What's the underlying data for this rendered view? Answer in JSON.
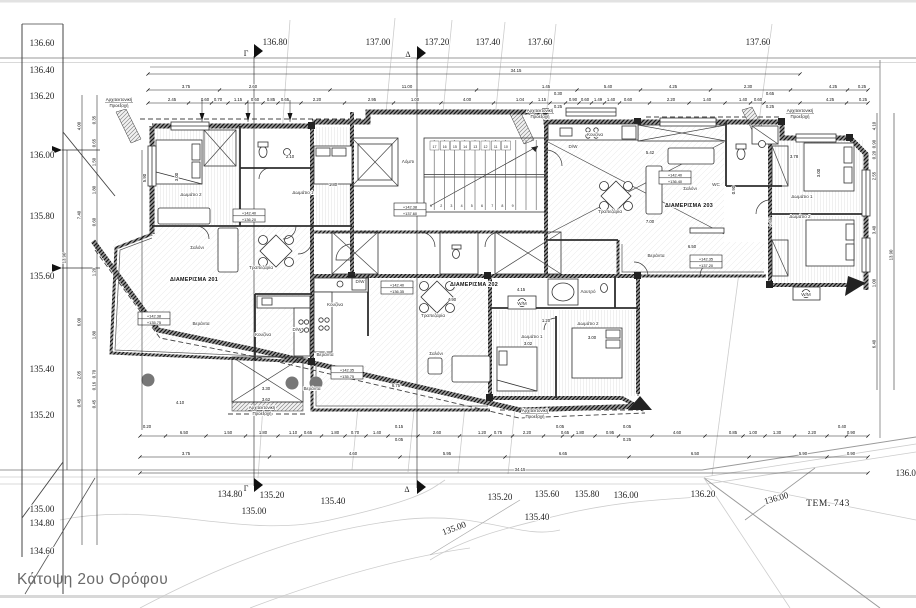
{
  "drawing": {
    "title": "Κάτοψη 2ου Ορόφου",
    "plot_label": "ΤΕΜ. 743"
  },
  "section_markers": {
    "gamma": "Γ",
    "delta": "Δ"
  },
  "colors": {
    "wall": "#3c3c3c",
    "contour": "#cccccc",
    "title_text": "#6a6a6a",
    "paper": "#ffffff"
  },
  "left_elevation_scale": [
    {
      "label": "136.60",
      "y": 43
    },
    {
      "label": "136.40",
      "y": 70
    },
    {
      "label": "136.20",
      "y": 96
    },
    {
      "label": "136.00",
      "y": 155
    },
    {
      "label": "135.80",
      "y": 216
    },
    {
      "label": "135.60",
      "y": 276
    },
    {
      "label": "135.40",
      "y": 369
    },
    {
      "label": "135.20",
      "y": 415
    },
    {
      "label": "135.00",
      "y": 509
    },
    {
      "label": "134.80",
      "y": 523
    },
    {
      "label": "134.60",
      "y": 551
    }
  ],
  "contour_labels": [
    {
      "t": "136.80",
      "x": 275,
      "y": 42
    },
    {
      "t": "137.00",
      "x": 378,
      "y": 42
    },
    {
      "t": "137.20",
      "x": 437,
      "y": 42
    },
    {
      "t": "137.40",
      "x": 488,
      "y": 42
    },
    {
      "t": "137.60",
      "x": 540,
      "y": 42
    },
    {
      "t": "137.60",
      "x": 758,
      "y": 42
    },
    {
      "t": "134.80",
      "x": 230,
      "y": 494
    },
    {
      "t": "135.20",
      "x": 272,
      "y": 495
    },
    {
      "t": "135.00",
      "x": 254,
      "y": 511
    },
    {
      "t": "135.40",
      "x": 333,
      "y": 501
    },
    {
      "t": "135.00",
      "x": 455,
      "y": 528,
      "rot": -20
    },
    {
      "t": "135.20",
      "x": 500,
      "y": 497
    },
    {
      "t": "135.60",
      "x": 547,
      "y": 494
    },
    {
      "t": "135.40",
      "x": 537,
      "y": 517
    },
    {
      "t": "135.80",
      "x": 587,
      "y": 494
    },
    {
      "t": "136.00",
      "x": 626,
      "y": 495
    },
    {
      "t": "136.20",
      "x": 703,
      "y": 494
    },
    {
      "t": "136.00",
      "x": 777,
      "y": 498,
      "rot": -16
    },
    {
      "t": "136.00",
      "x": 908,
      "y": 473
    }
  ],
  "apartment_labels": [
    {
      "t": "ΔΙΑΜΕΡΙΣΜΑ 201",
      "x": 194,
      "y": 281
    },
    {
      "t": "ΔΙΑΜΕΡΙΣΜΑ 202",
      "x": 474,
      "y": 286
    },
    {
      "t": "ΔΙΑΜΕΡΙΣΜΑ 203",
      "x": 689,
      "y": 207
    }
  ],
  "room_labels": [
    {
      "t": "Δωμάτιο 2",
      "x": 191,
      "y": 196
    },
    {
      "t": "Δωμάτιο 1",
      "x": 303,
      "y": 194
    },
    {
      "t": "Σαλόνι",
      "x": 197,
      "y": 249
    },
    {
      "t": "Τραπεζαρία",
      "x": 261,
      "y": 269
    },
    {
      "t": "Κουζίνα",
      "x": 263,
      "y": 336
    },
    {
      "t": "D/W",
      "x": 297,
      "y": 331
    },
    {
      "t": "Βεράντα",
      "x": 201,
      "y": 325
    },
    {
      "t": "Βεράντα",
      "x": 325,
      "y": 356
    },
    {
      "t": "Λόμπι",
      "x": 408,
      "y": 163
    },
    {
      "t": "Κουζίνα",
      "x": 335,
      "y": 306
    },
    {
      "t": "D/W",
      "x": 360,
      "y": 283
    },
    {
      "t": "Τραπεζαρία",
      "x": 433,
      "y": 317
    },
    {
      "t": "Σαλόνι",
      "x": 436,
      "y": 355
    },
    {
      "t": "Βεράντα",
      "x": 312,
      "y": 390
    },
    {
      "t": "Λουτρό",
      "x": 588,
      "y": 293
    },
    {
      "t": "W/M",
      "x": 522,
      "y": 305
    },
    {
      "t": "Δωμάτιο 1",
      "x": 532,
      "y": 338
    },
    {
      "t": "Δωμάτιο 2",
      "x": 588,
      "y": 325
    },
    {
      "t": "Κουζίνα",
      "x": 595,
      "y": 136
    },
    {
      "t": "D/W",
      "x": 573,
      "y": 148
    },
    {
      "t": "Τραπεζαρία",
      "x": 610,
      "y": 213
    },
    {
      "t": "Σαλόνι",
      "x": 690,
      "y": 190
    },
    {
      "t": "WC",
      "x": 716,
      "y": 186
    },
    {
      "t": "Βεράντα",
      "x": 656,
      "y": 257
    },
    {
      "t": "Δωμάτιο 1",
      "x": 802,
      "y": 198
    },
    {
      "t": "Δωμάτιο 2",
      "x": 800,
      "y": 218
    },
    {
      "t": "W/M",
      "x": 806,
      "y": 296
    }
  ],
  "level_markers": [
    {
      "main": "+142.40",
      "sub": "+136.20",
      "x": 249,
      "y": 209
    },
    {
      "main": "+142.38",
      "sub": "+135.75",
      "x": 154,
      "y": 312
    },
    {
      "main": "+142.38",
      "sub": "+137.60",
      "x": 410,
      "y": 203
    },
    {
      "main": "+142.40",
      "sub": "+136.35",
      "x": 397,
      "y": 281
    },
    {
      "main": "+142.35",
      "sub": "+135.75",
      "x": 347,
      "y": 366
    },
    {
      "main": "+142.40",
      "sub": "+136.40",
      "x": 675,
      "y": 171
    },
    {
      "main": "+142.35",
      "sub": "+137.20",
      "x": 706,
      "y": 255
    }
  ],
  "projection_note": {
    "line1": "Αρχιτεκτονική",
    "line2": "Προεξοχή",
    "positions": [
      {
        "x": 119,
        "y": 101
      },
      {
        "x": 540,
        "y": 112
      },
      {
        "x": 800,
        "y": 112
      },
      {
        "x": 535,
        "y": 412
      },
      {
        "x": 262,
        "y": 409
      }
    ]
  },
  "stairs": {
    "top_numbers": [
      "17",
      "16",
      "15",
      "14",
      "13",
      "12",
      "11",
      "10"
    ],
    "bottom_numbers": [
      "1",
      "2",
      "3",
      "4",
      "5",
      "6",
      "7",
      "8",
      "9"
    ]
  },
  "dimensions": {
    "h_rows": [
      {
        "y": 74,
        "x1": 148,
        "x2": 800,
        "items": [
          {
            "v": "34.15",
            "x": 516
          }
        ]
      },
      {
        "y": 90,
        "x1": 148,
        "x2": 868,
        "items": [
          {
            "v": "3.75",
            "x": 186
          },
          {
            "v": "2.60",
            "x": 253
          },
          {
            "v": "11.00",
            "x": 407
          },
          {
            "v": "1.45",
            "x": 546
          },
          {
            "v": "5.40",
            "x": 608
          },
          {
            "v": "4.25",
            "x": 673
          },
          {
            "v": "2.30",
            "x": 748
          },
          {
            "v": "4.25",
            "x": 833
          },
          {
            "v": "0.25",
            "x": 862
          }
        ]
      },
      {
        "y": 103,
        "x1": 148,
        "x2": 868,
        "items": [
          {
            "v": "2.45",
            "x": 172
          },
          {
            "v": "0.60",
            "x": 205
          },
          {
            "v": "0.70",
            "x": 218
          },
          {
            "v": "1.15",
            "x": 238
          },
          {
            "v": "0.60",
            "x": 255
          },
          {
            "v": "0.85",
            "x": 271
          },
          {
            "v": "0.65",
            "x": 285
          },
          {
            "v": "2.20",
            "x": 317
          },
          {
            "v": "2.95",
            "x": 372
          },
          {
            "v": "1.00",
            "x": 415
          },
          {
            "v": "4.00",
            "x": 467
          },
          {
            "v": "1.04",
            "x": 520
          },
          {
            "v": "1.15",
            "x": 542
          },
          {
            "v": "0.30",
            "x": 558,
            "dy": -6
          },
          {
            "v": "0.25",
            "x": 558,
            "dy": 7
          },
          {
            "v": "0.90",
            "x": 573
          },
          {
            "v": "0.60",
            "x": 585
          },
          {
            "v": "1.49",
            "x": 598
          },
          {
            "v": "1.40",
            "x": 611
          },
          {
            "v": "0.60",
            "x": 628
          },
          {
            "v": "2.20",
            "x": 671
          },
          {
            "v": "1.40",
            "x": 707
          },
          {
            "v": "1.40",
            "x": 743
          },
          {
            "v": "0.60",
            "x": 758
          },
          {
            "v": "0.65",
            "x": 770,
            "dy": -6
          },
          {
            "v": "0.25",
            "x": 770,
            "dy": 7
          },
          {
            "v": "4.25",
            "x": 830
          },
          {
            "v": "0.25",
            "x": 863
          }
        ]
      },
      {
        "y": 436,
        "x1": 140,
        "x2": 868,
        "items": [
          {
            "v": "0.20",
            "x": 147,
            "dy": -6
          },
          {
            "v": "6.50",
            "x": 184
          },
          {
            "v": "1.50",
            "x": 228
          },
          {
            "v": "1.80",
            "x": 263
          },
          {
            "v": "1.10",
            "x": 293
          },
          {
            "v": "0.65",
            "x": 308
          },
          {
            "v": "1.80",
            "x": 335
          },
          {
            "v": "0.70",
            "x": 355
          },
          {
            "v": "1.40",
            "x": 377
          },
          {
            "v": "0.15",
            "x": 399,
            "dy": -6
          },
          {
            "v": "0.05",
            "x": 399,
            "dy": 7
          },
          {
            "v": "2.60",
            "x": 437
          },
          {
            "v": "1.20",
            "x": 482
          },
          {
            "v": "0.75",
            "x": 498
          },
          {
            "v": "2.20",
            "x": 527
          },
          {
            "v": "0.05",
            "x": 560,
            "dy": -6
          },
          {
            "v": "0.65",
            "x": 565
          },
          {
            "v": "1.80",
            "x": 580
          },
          {
            "v": "0.95",
            "x": 610
          },
          {
            "v": "0.05",
            "x": 627,
            "dy": -6
          },
          {
            "v": "0.25",
            "x": 627,
            "dy": 7
          },
          {
            "v": "4.60",
            "x": 677
          },
          {
            "v": "0.85",
            "x": 733
          },
          {
            "v": "1.00",
            "x": 753
          },
          {
            "v": "1.30",
            "x": 777
          },
          {
            "v": "2.20",
            "x": 812
          },
          {
            "v": "0.40",
            "x": 842,
            "dy": -6
          },
          {
            "v": "0.90",
            "x": 851
          }
        ]
      },
      {
        "y": 457,
        "x1": 140,
        "x2": 868,
        "items": [
          {
            "v": "3.75",
            "x": 186
          },
          {
            "v": "4.60",
            "x": 353
          },
          {
            "v": "5.95",
            "x": 447
          },
          {
            "v": "6.65",
            "x": 563
          },
          {
            "v": "6.50",
            "x": 695
          },
          {
            "v": "5.90",
            "x": 803
          },
          {
            "v": "0.90",
            "x": 851
          }
        ]
      },
      {
        "y": 473,
        "x1": 140,
        "x2": 868,
        "items": [
          {
            "v": "34.15",
            "x": 520
          }
        ]
      }
    ],
    "v_lines": [
      {
        "x": 67,
        "y1": 150,
        "y2": 470
      },
      {
        "x": 82,
        "y1": 95,
        "y2": 545
      },
      {
        "x": 97,
        "y1": 95,
        "y2": 545
      },
      {
        "x": 142,
        "y1": 150,
        "y2": 430
      },
      {
        "x": 202,
        "y1": 100,
        "y2": 122
      },
      {
        "x": 248,
        "y1": 100,
        "y2": 122
      },
      {
        "x": 290,
        "y1": 100,
        "y2": 122
      },
      {
        "x": 877,
        "y1": 113,
        "y2": 390
      },
      {
        "x": 894,
        "y1": 113,
        "y2": 390
      }
    ],
    "v_items": [
      {
        "v": "13.90",
        "x": 67,
        "y": 258
      },
      {
        "v": "4.00",
        "x": 82,
        "y": 126
      },
      {
        "v": "7.40",
        "x": 82,
        "y": 215
      },
      {
        "v": "6.00",
        "x": 82,
        "y": 322
      },
      {
        "v": "2.05",
        "x": 82,
        "y": 375
      },
      {
        "v": "0.45",
        "x": 82,
        "y": 403
      },
      {
        "v": "0.35",
        "x": 97,
        "y": 120
      },
      {
        "v": "0.65",
        "x": 97,
        "y": 143
      },
      {
        "v": "1.50",
        "x": 97,
        "y": 162
      },
      {
        "v": "1.80",
        "x": 97,
        "y": 190
      },
      {
        "v": "0.60",
        "x": 97,
        "y": 222
      },
      {
        "v": "1.20",
        "x": 97,
        "y": 272
      },
      {
        "v": "1.80",
        "x": 97,
        "y": 335
      },
      {
        "v": "0.70",
        "x": 97,
        "y": 374
      },
      {
        "v": "0.16",
        "x": 97,
        "y": 386
      },
      {
        "v": "0.45",
        "x": 97,
        "y": 404
      },
      {
        "v": "4.10",
        "x": 877,
        "y": 126
      },
      {
        "v": "0.90",
        "x": 877,
        "y": 144
      },
      {
        "v": "0.20",
        "x": 877,
        "y": 155
      },
      {
        "v": "2.55",
        "x": 877,
        "y": 176
      },
      {
        "v": "3.40",
        "x": 877,
        "y": 230
      },
      {
        "v": "1.00",
        "x": 877,
        "y": 283
      },
      {
        "v": "6.40",
        "x": 877,
        "y": 344
      },
      {
        "v": "13.90",
        "x": 894,
        "y": 255
      }
    ],
    "interior": [
      {
        "v": "3.00",
        "x": 178,
        "y": 177,
        "rot": -90
      },
      {
        "v": "5.90",
        "x": 146,
        "y": 178,
        "rot": -90
      },
      {
        "v": "2.10",
        "x": 290,
        "y": 158
      },
      {
        "v": "1.80",
        "x": 333,
        "y": 186
      },
      {
        "v": "4.15",
        "x": 521,
        "y": 291
      },
      {
        "v": "1.20",
        "x": 546,
        "y": 322
      },
      {
        "v": "3.02",
        "x": 528,
        "y": 345
      },
      {
        "v": "3.00",
        "x": 592,
        "y": 339
      },
      {
        "v": "5.42",
        "x": 650,
        "y": 154
      },
      {
        "v": "7.00",
        "x": 650,
        "y": 223
      },
      {
        "v": "6.50",
        "x": 692,
        "y": 248
      },
      {
        "v": "3.78",
        "x": 794,
        "y": 158
      },
      {
        "v": "3.00",
        "x": 820,
        "y": 173,
        "rot": -90
      },
      {
        "v": "6.75",
        "x": 396,
        "y": 387
      },
      {
        "v": "4.10",
        "x": 180,
        "y": 404
      },
      {
        "v": "3.30",
        "x": 266,
        "y": 390
      },
      {
        "v": "3.62",
        "x": 266,
        "y": 401
      },
      {
        "v": "4.90",
        "x": 452,
        "y": 301
      },
      {
        "v": "2.65",
        "x": 772,
        "y": 222,
        "rot": -90
      },
      {
        "v": "0.90",
        "x": 735,
        "y": 190,
        "rot": -90
      }
    ]
  }
}
